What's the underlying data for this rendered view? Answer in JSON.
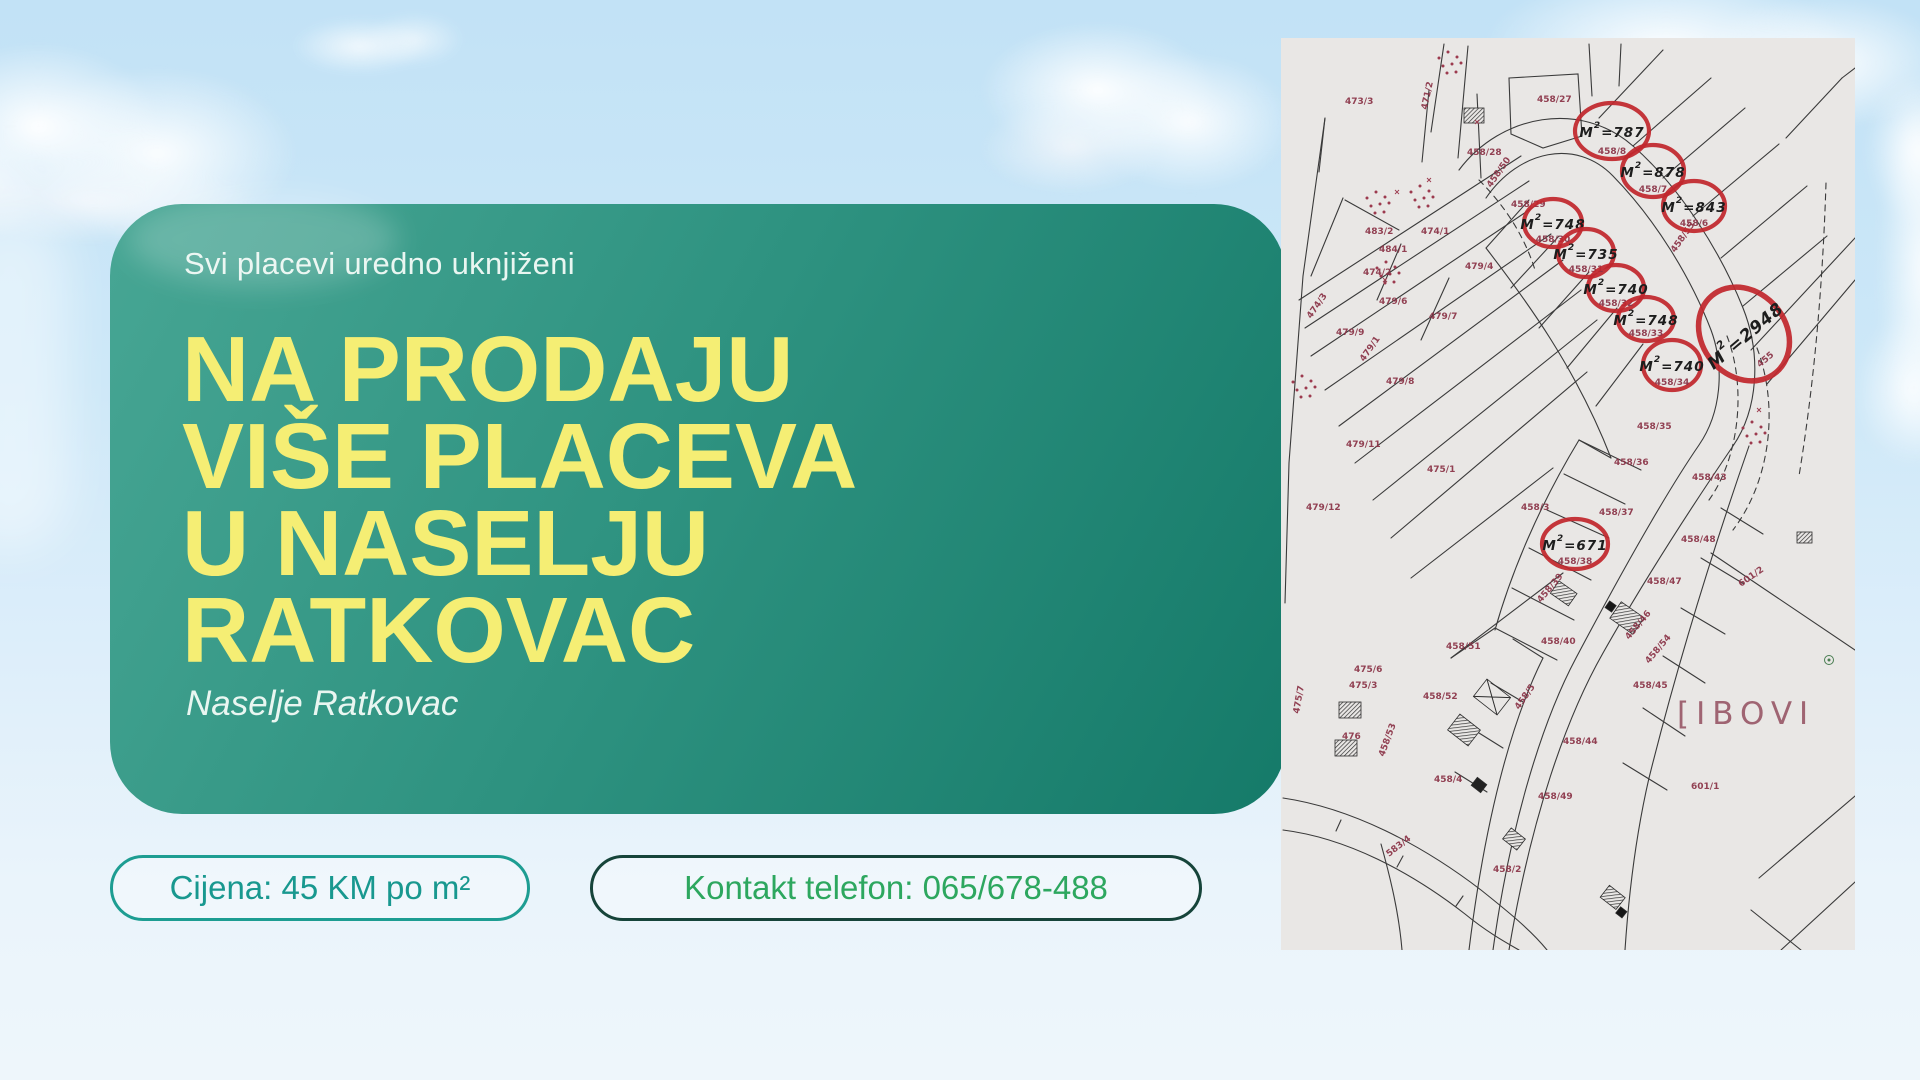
{
  "poster": {
    "tagline": "Svi placevi uredno uknjiženi",
    "heading_lines": [
      "NA PRODAJU",
      "VIŠE PLACEVA",
      "U NASELJU",
      "RATKOVAC"
    ],
    "subtitle": "Naselje Ratkovac",
    "price_pill": "Cijena: 45 KM po m²",
    "contact_pill": "Kontakt telefon: 065/678-488"
  },
  "colors": {
    "card_gradient_start": "#47a694",
    "card_gradient_end": "#157a69",
    "heading_yellow": "#f5ee74",
    "tag_text": "#e9f6f1",
    "price_text": "#18988f",
    "price_border": "#1d9d92",
    "contact_text": "#2da75f",
    "contact_border": "#16443a",
    "map_bg": "#e9e7e5",
    "map_line": "#3a3a3a",
    "parcel_label": "#8a3246",
    "circle_red": "#c1272d"
  },
  "map": {
    "watermark": "[IBOVI",
    "area_symbol": "M",
    "area_sup": "2",
    "circles": [
      {
        "v": "787",
        "p": "458/8",
        "cx": 331,
        "cy": 93,
        "rx": 37,
        "ry": 28
      },
      {
        "v": "878",
        "p": "458/7",
        "cx": 372,
        "cy": 133,
        "rx": 31,
        "ry": 26
      },
      {
        "v": "843",
        "p": "458/6",
        "cx": 413,
        "cy": 168,
        "rx": 31,
        "ry": 25
      },
      {
        "v": "748",
        "p": "458/30",
        "cx": 272,
        "cy": 185,
        "rx": 29,
        "ry": 24
      },
      {
        "v": "735",
        "p": "458/31",
        "cx": 305,
        "cy": 215,
        "rx": 28,
        "ry": 24
      },
      {
        "v": "740",
        "p": "458/32",
        "cx": 335,
        "cy": 250,
        "rx": 28,
        "ry": 23
      },
      {
        "v": "748",
        "p": "458/33",
        "cx": 365,
        "cy": 281,
        "rx": 28,
        "ry": 22
      },
      {
        "v": "740",
        "p": "458/34",
        "cx": 391,
        "cy": 327,
        "rx": 29,
        "ry": 25
      },
      {
        "v": "2948",
        "p": "455",
        "cx": 463,
        "cy": 296,
        "rx": 42,
        "ry": 50,
        "r": -40,
        "big": true
      },
      {
        "v": "671",
        "p": "458/38",
        "cx": 294,
        "cy": 506,
        "rx": 33,
        "ry": 25
      }
    ],
    "labels": [
      {
        "t": "473/3",
        "x": 64,
        "y": 66
      },
      {
        "t": "471/2",
        "x": 146,
        "y": 72,
        "r": -78
      },
      {
        "t": "458/27",
        "x": 256,
        "y": 64
      },
      {
        "t": "458/28",
        "x": 186,
        "y": 117
      },
      {
        "t": "458/50",
        "x": 210,
        "y": 150,
        "r": -55
      },
      {
        "t": "458/29",
        "x": 230,
        "y": 169
      },
      {
        "t": "483/2",
        "x": 84,
        "y": 196
      },
      {
        "t": "474/1",
        "x": 140,
        "y": 196
      },
      {
        "t": "484/1",
        "x": 98,
        "y": 214
      },
      {
        "t": "474/2",
        "x": 82,
        "y": 237
      },
      {
        "t": "479/4",
        "x": 184,
        "y": 231
      },
      {
        "t": "479/6",
        "x": 98,
        "y": 266
      },
      {
        "t": "474/3",
        "x": 30,
        "y": 281,
        "r": -55
      },
      {
        "t": "479/7",
        "x": 148,
        "y": 281
      },
      {
        "t": "479/9",
        "x": 55,
        "y": 297
      },
      {
        "t": "479/1",
        "x": 83,
        "y": 324,
        "r": -55
      },
      {
        "t": "479/8",
        "x": 105,
        "y": 346
      },
      {
        "t": "458/55",
        "x": 394,
        "y": 215,
        "r": -55
      },
      {
        "t": "458/35",
        "x": 356,
        "y": 391
      },
      {
        "t": "479/11",
        "x": 65,
        "y": 409
      },
      {
        "t": "475/1",
        "x": 146,
        "y": 434
      },
      {
        "t": "458/36",
        "x": 333,
        "y": 427
      },
      {
        "t": "458/43",
        "x": 411,
        "y": 442
      },
      {
        "t": "479/12",
        "x": 25,
        "y": 472
      },
      {
        "t": "458/3",
        "x": 240,
        "y": 472
      },
      {
        "t": "458/37",
        "x": 318,
        "y": 477
      },
      {
        "t": "458/48",
        "x": 400,
        "y": 504
      },
      {
        "t": "458/47",
        "x": 366,
        "y": 546
      },
      {
        "t": "458/39",
        "x": 260,
        "y": 565,
        "r": -50
      },
      {
        "t": "601/2",
        "x": 460,
        "y": 549,
        "r": -35
      },
      {
        "t": "458/40",
        "x": 260,
        "y": 606
      },
      {
        "t": "458/46",
        "x": 348,
        "y": 602,
        "r": -50
      },
      {
        "t": "458/51",
        "x": 165,
        "y": 611
      },
      {
        "t": "458/54",
        "x": 368,
        "y": 626,
        "r": -50
      },
      {
        "t": "475/6",
        "x": 73,
        "y": 634
      },
      {
        "t": "475/3",
        "x": 68,
        "y": 650
      },
      {
        "t": "458/45",
        "x": 352,
        "y": 650
      },
      {
        "t": "475/7",
        "x": 18,
        "y": 676,
        "r": -80
      },
      {
        "t": "458/52",
        "x": 142,
        "y": 661
      },
      {
        "t": "476",
        "x": 61,
        "y": 701
      },
      {
        "t": "458/53",
        "x": 103,
        "y": 719,
        "r": -70
      },
      {
        "t": "458/5",
        "x": 238,
        "y": 672,
        "r": -55
      },
      {
        "t": "458/44",
        "x": 282,
        "y": 706
      },
      {
        "t": "458/4",
        "x": 153,
        "y": 744
      },
      {
        "t": "601/1",
        "x": 410,
        "y": 751
      },
      {
        "t": "458/49",
        "x": 257,
        "y": 761
      },
      {
        "t": "583/4",
        "x": 108,
        "y": 819,
        "r": -38
      },
      {
        "t": "458/2",
        "x": 212,
        "y": 834
      }
    ]
  }
}
